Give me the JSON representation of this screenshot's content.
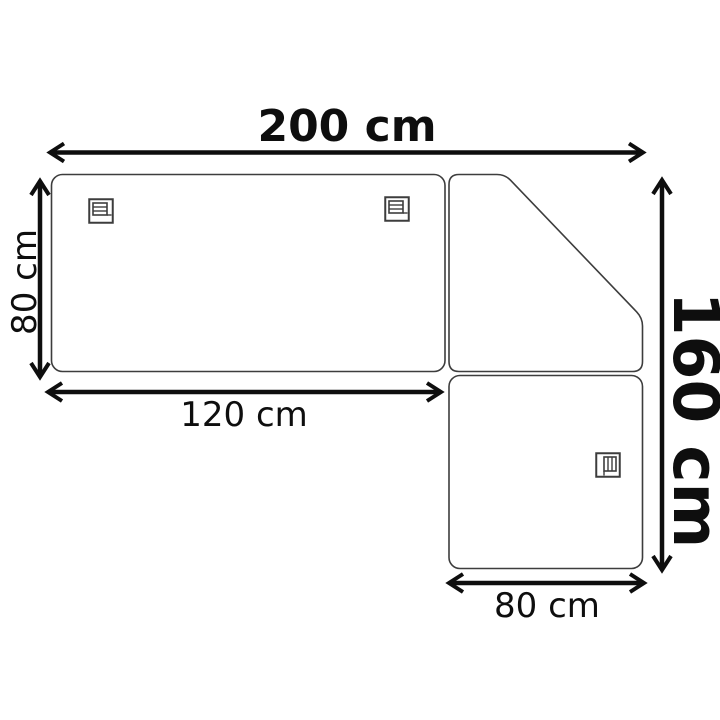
{
  "diagram": {
    "type": "furniture-dimension-diagram",
    "view": "top-view-corner-layout",
    "background_color": "#ffffff",
    "outline_color": "#3d3d3d",
    "dimension_color": "#0e0e0e",
    "dimensions": {
      "total_width": {
        "label": "200 cm",
        "value": 200,
        "unit": "cm",
        "orientation": "horizontal",
        "style": "bold"
      },
      "left_section_depth": {
        "label": "80 cm",
        "value": 80,
        "unit": "cm",
        "orientation": "vertical",
        "style": "regular"
      },
      "left_section_width": {
        "label": "120 cm",
        "value": 120,
        "unit": "cm",
        "orientation": "horizontal",
        "style": "regular"
      },
      "right_section_width": {
        "label": "80 cm",
        "value": 80,
        "unit": "cm",
        "orientation": "horizontal",
        "style": "regular"
      },
      "total_depth": {
        "label": "160 cm",
        "value": 160,
        "unit": "cm",
        "orientation": "vertical",
        "style": "bold"
      }
    },
    "sections": [
      {
        "name": "left-rectangular-section",
        "shape": "rounded-rectangle",
        "icons": [
          "hatch-icon",
          "hatch-icon"
        ]
      },
      {
        "name": "corner-diagonal-section",
        "shape": "rounded-pentagon-diagonal",
        "icons": []
      },
      {
        "name": "bottom-right-square-section",
        "shape": "rounded-square",
        "icons": [
          "hatch-icon-rotated"
        ]
      }
    ]
  }
}
